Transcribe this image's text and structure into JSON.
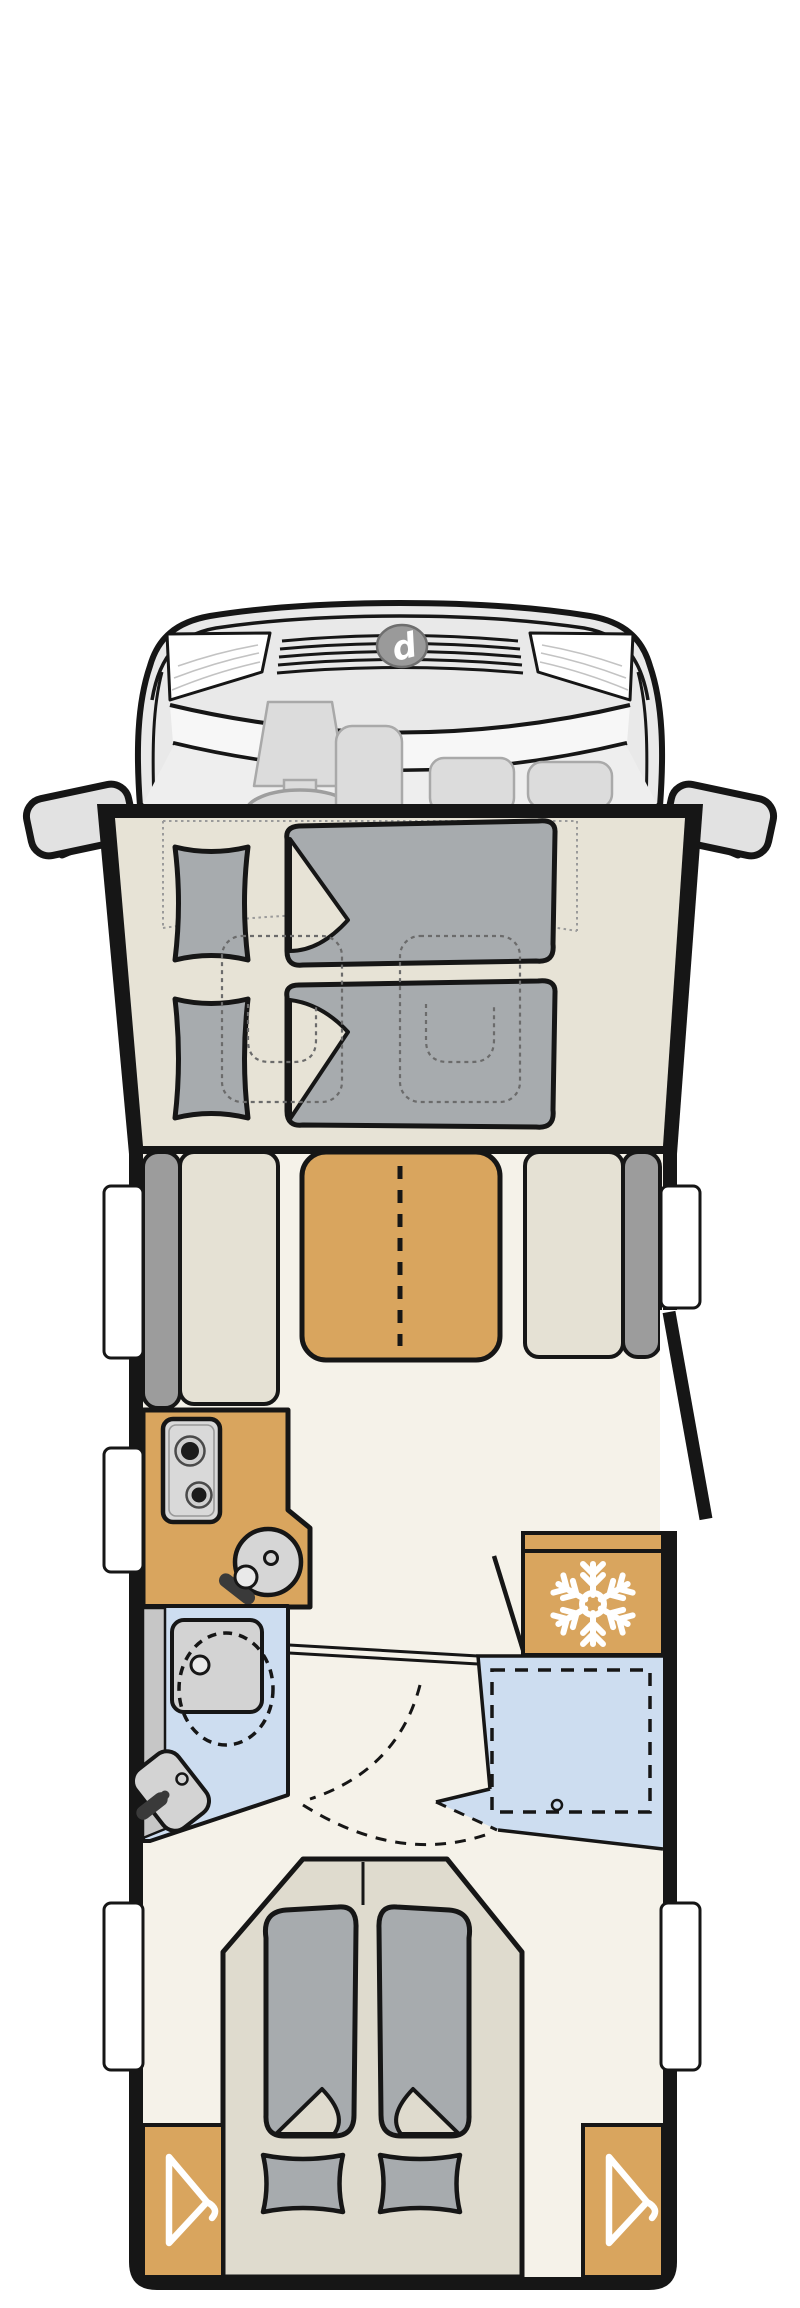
{
  "title": "Motorhome floor plan (top view)",
  "logo_letter": "d",
  "theme": {
    "page_bg": "#ffffff",
    "outline": "#161616",
    "cab_body": "#e9e9e9",
    "cab_floor": "#eeeeee",
    "windshield": "#f7f7f7",
    "seat_gray": "#dcdcdc",
    "seat_stroke": "#a9a9a9",
    "logo_gray": "#9a9a9a",
    "bed_floor": "#e7e3d6",
    "floor": "#f5f2e9",
    "textile": "#a7abae",
    "cushion": "#e5e1d4",
    "backrest": "#9c9c9c",
    "wood": "#d9a55e",
    "appliance": "#d6d6d6",
    "appliance_dark": "#1c1c1c",
    "wet_blue": "#cdddf0",
    "fixture": "#d3d3d3",
    "fixture_band": "#c6c6c6",
    "faucet": "#3a3a3a",
    "platform": "#dfdbce",
    "icon_white": "#ffffff",
    "dotted": "#9a9a9a",
    "dashed_seat": "#6b6b6b"
  },
  "regions": {
    "cab": "driver-cab",
    "front_bed": "drop-down-front-bed",
    "dinette": "half-dinette-with-table",
    "kitchen": "kitchen-block",
    "fridge": "refrigerator",
    "bathroom": "washroom",
    "shower": "shower-cabin",
    "rear_bed": "rear-double-bed",
    "wardrobe_count": 2,
    "window_count": 5,
    "burner_count": 2
  },
  "icons": [
    "snowflake-icon",
    "clothes-hanger-icon",
    "steering-wheel-icon",
    "brand-logo-icon"
  ]
}
